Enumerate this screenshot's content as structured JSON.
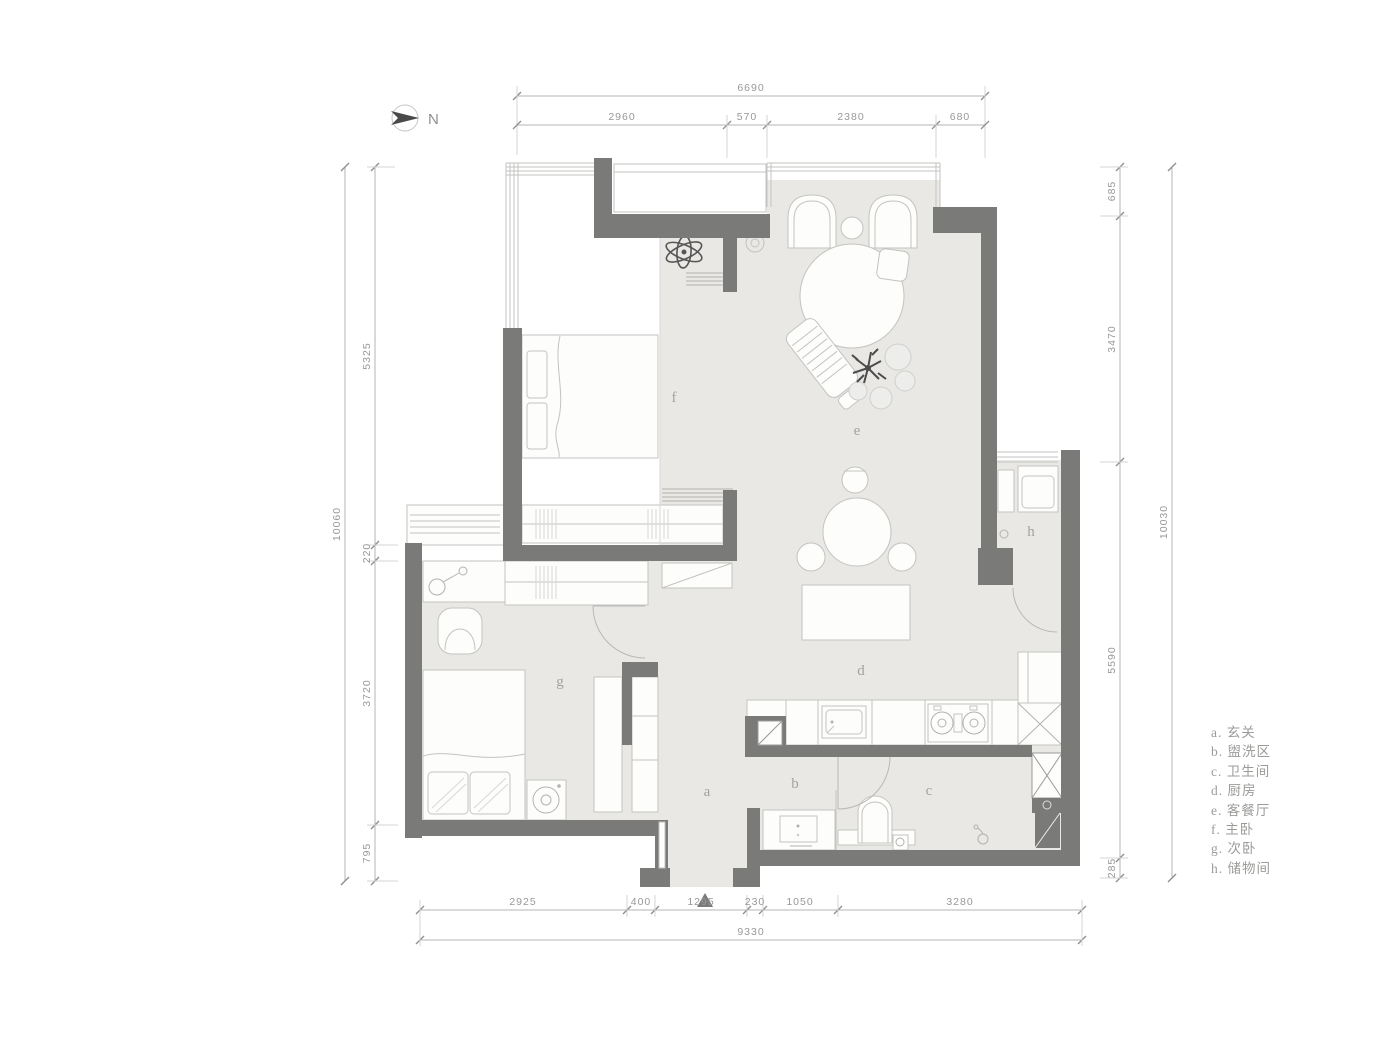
{
  "north": {
    "label": "N"
  },
  "dimensions": {
    "top": {
      "total": "6690",
      "segments": [
        "2960",
        "570",
        "2380",
        "680"
      ]
    },
    "left": {
      "total": "10060",
      "segments": [
        "5325",
        "220",
        "3720",
        "795"
      ]
    },
    "right": {
      "total": "10030",
      "segments": [
        "685",
        "3470",
        "5590",
        "285"
      ]
    },
    "bottom": {
      "total": "9330",
      "segments": [
        "2925",
        "400",
        "1295",
        "230",
        "1050",
        "3280"
      ]
    }
  },
  "rooms": [
    {
      "letter": "a"
    },
    {
      "letter": "b"
    },
    {
      "letter": "c"
    },
    {
      "letter": "d"
    },
    {
      "letter": "e"
    },
    {
      "letter": "f"
    },
    {
      "letter": "g"
    },
    {
      "letter": "h"
    }
  ],
  "legend": {
    "items": [
      {
        "label": "a. 玄关"
      },
      {
        "label": "b. 盥洗区"
      },
      {
        "label": "c. 卫生间"
      },
      {
        "label": "d. 厨房"
      },
      {
        "label": "e. 客餐厅"
      },
      {
        "label": "f. 主卧"
      },
      {
        "label": "g. 次卧"
      },
      {
        "label": "h. 储物间"
      }
    ]
  },
  "colors": {
    "wall": "#7a7a78",
    "floor": "#e9e8e5",
    "accent_dark": "#4c4c4c",
    "line": "#c3c3c1"
  }
}
